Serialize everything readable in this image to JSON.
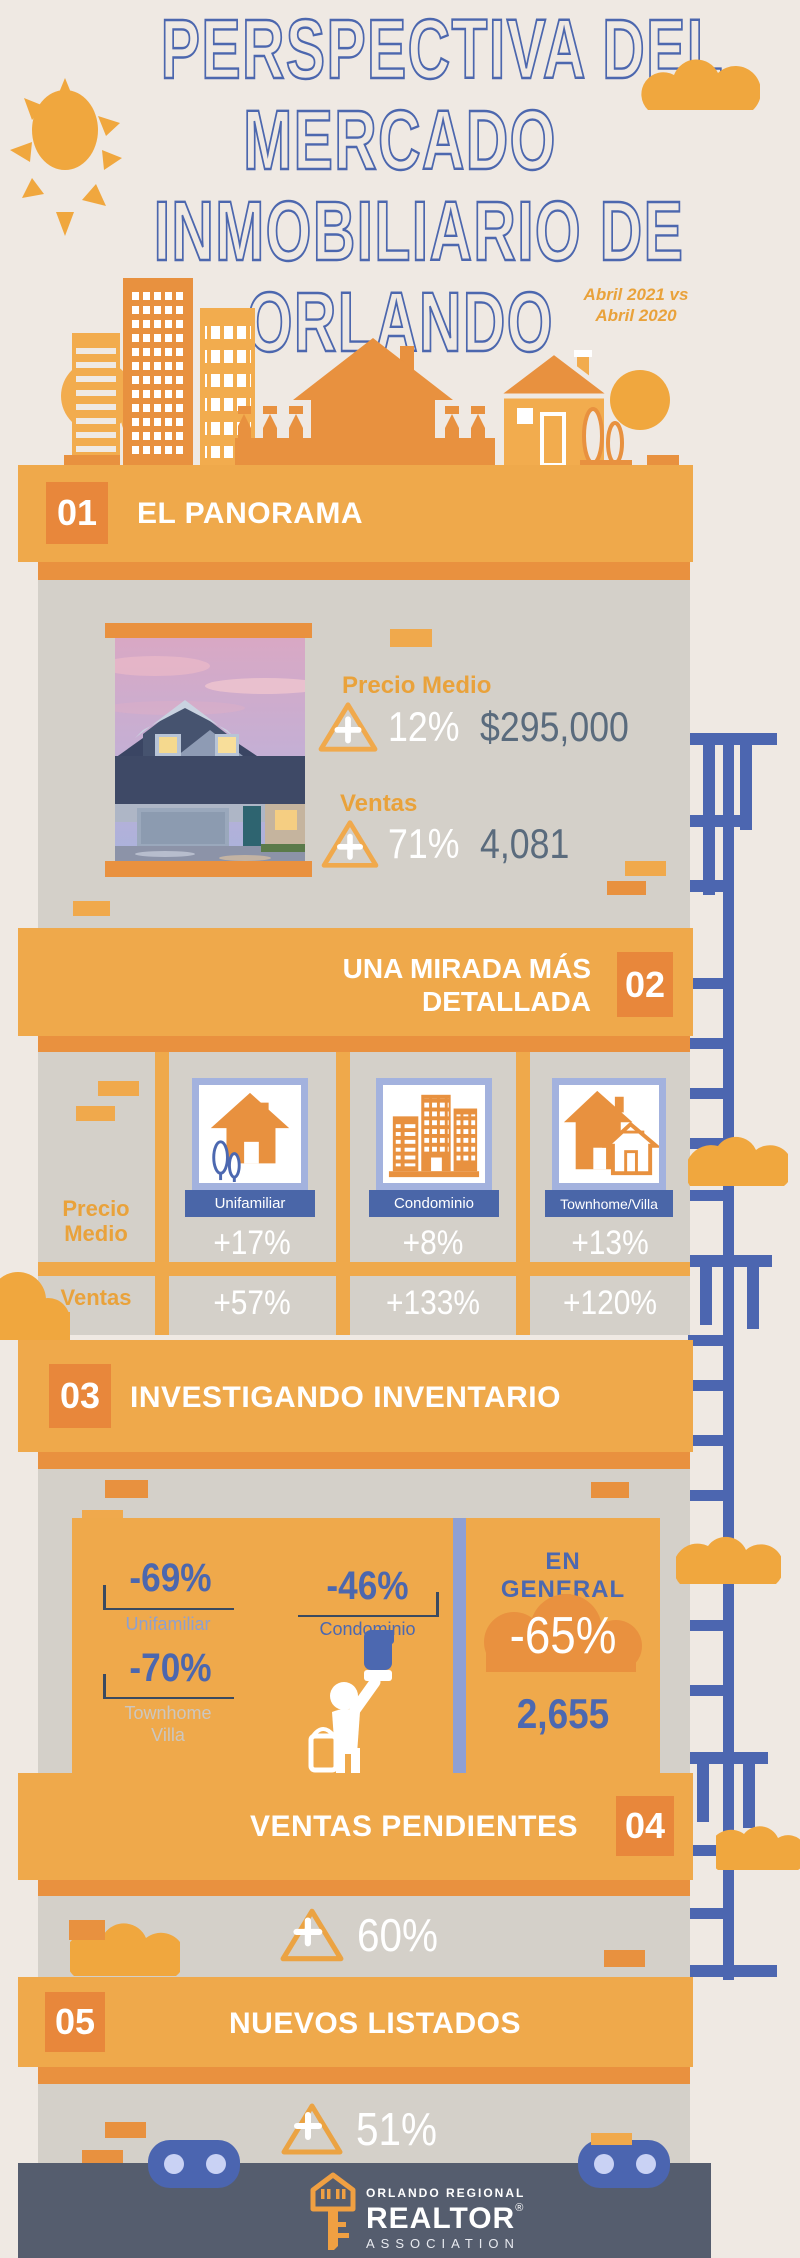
{
  "header": {
    "title_lines": [
      "PERSPECTIVA DEL",
      "MERCADO",
      "INMOBILIARIO DE",
      "ORLANDO"
    ],
    "subtitle_line1": "Abril 2021 vs",
    "subtitle_line2": "Abril 2020"
  },
  "colors": {
    "background": "#EFE9E3",
    "panel_gray": "#D4D0C9",
    "banner_orange": "#EFA94B",
    "shadow_orange": "#E9913F",
    "number_square_orange": "#E8873B",
    "title_blue": "#4C67AE",
    "periwinkle": "#A3B2DE",
    "ribbon_blue": "#4A66A8",
    "slate_text": "#5A6B7D",
    "orange_text": "#E9A23B",
    "footer_bg": "#555D6E",
    "wheel_blue": "#4B65B0"
  },
  "icons": {
    "sun": "sun",
    "clouds": "cloud",
    "ladder": "scaffold-ladder",
    "increase": "triangle-plus",
    "single_family": "house",
    "condo": "buildings",
    "townhome": "double-house",
    "painter": "painter-figure",
    "logo_key": "realtor-house-key",
    "wheels": "truck-wheel"
  },
  "sections": {
    "panorama": {
      "number": "01",
      "title": "EL PANORAMA",
      "rows": [
        {
          "label": "Precio Medio",
          "pct": "12%",
          "value": "$295,000"
        },
        {
          "label": "Ventas",
          "pct": "71%",
          "value": "4,081"
        }
      ]
    },
    "detallada": {
      "number": "02",
      "title_line1": "UNA MIRADA MÁS",
      "title_line2": "DETALLADA",
      "row_labels": [
        "Precio Medio",
        "Ventas"
      ],
      "columns": [
        {
          "label": "Unifamiliar",
          "precio_medio": "+17%",
          "ventas": "+57%"
        },
        {
          "label": "Condominio",
          "precio_medio": "+8%",
          "ventas": "+133%"
        },
        {
          "label": "Townhome/Villa",
          "precio_medio": "+13%",
          "ventas": "+120%"
        }
      ]
    },
    "inventario": {
      "number": "03",
      "title": "INVESTIGANDO INVENTARIO",
      "items": [
        {
          "pct": "-69%",
          "label": "Unifamiliar"
        },
        {
          "pct": "-46%",
          "label": "Condominio"
        },
        {
          "pct": "-70%",
          "label": "Townhome Villa"
        }
      ],
      "overall_label": "EN GENERAL",
      "overall_pct": "-65%",
      "overall_total": "2,655"
    },
    "pendientes": {
      "number": "04",
      "title": "VENTAS PENDIENTES",
      "pct": "60%"
    },
    "listados": {
      "number": "05",
      "title": "NUEVOS LISTADOS",
      "pct": "51%"
    }
  },
  "footer": {
    "org_top": "ORLANDO REGIONAL",
    "org_main": "REALTOR",
    "org_reg": "®",
    "org_bottom": "ASSOCIATION"
  },
  "chart_data": {
    "type": "table",
    "title": "Perspectiva del Mercado Inmobiliario de Orlando",
    "subtitle": "Abril 2021 vs Abril 2020",
    "sections": [
      {
        "name": "El Panorama",
        "metrics": [
          {
            "label": "Precio Medio",
            "change": "+12%",
            "value": "$295,000"
          },
          {
            "label": "Ventas",
            "change": "+71%",
            "value": 4081
          }
        ]
      },
      {
        "name": "Una Mirada Más Detallada",
        "categories": [
          "Unifamiliar",
          "Condominio",
          "Townhome/Villa"
        ],
        "series": [
          {
            "name": "Precio Medio",
            "values": [
              "+17%",
              "+8%",
              "+13%"
            ]
          },
          {
            "name": "Ventas",
            "values": [
              "+57%",
              "+133%",
              "+120%"
            ]
          }
        ]
      },
      {
        "name": "Investigando Inventario",
        "values": [
          {
            "label": "Unifamiliar",
            "change": "-69%"
          },
          {
            "label": "Condominio",
            "change": "-46%"
          },
          {
            "label": "Townhome Villa",
            "change": "-70%"
          },
          {
            "label": "En General",
            "change": "-65%",
            "total": 2655
          }
        ]
      },
      {
        "name": "Ventas Pendientes",
        "change": "+60%"
      },
      {
        "name": "Nuevos Listados",
        "change": "+51%"
      }
    ]
  }
}
